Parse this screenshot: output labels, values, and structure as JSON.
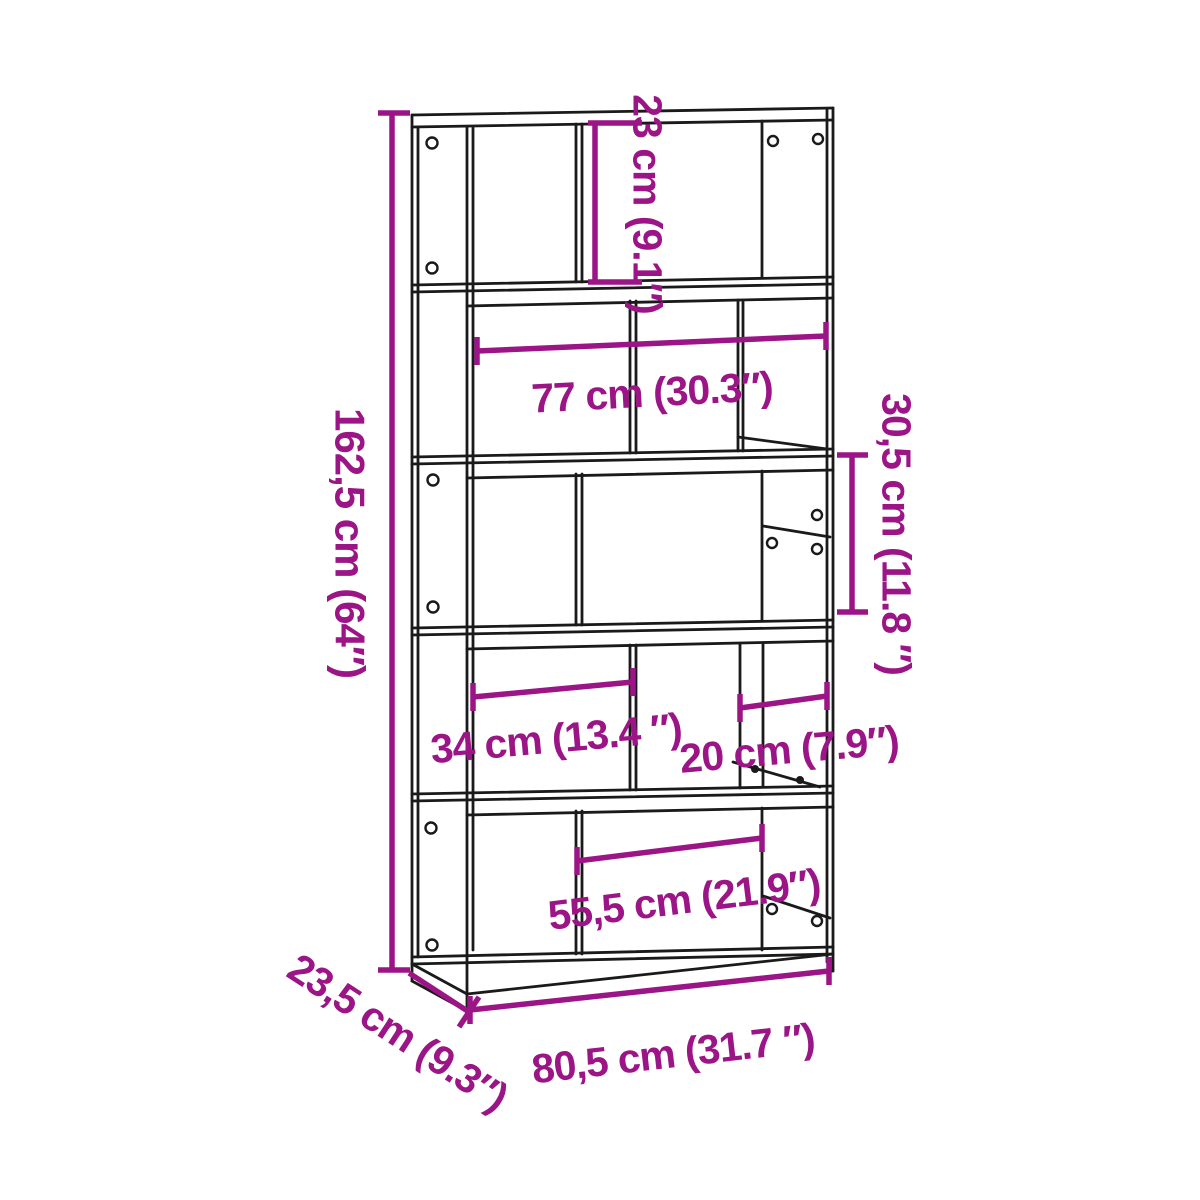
{
  "diagram": {
    "colors": {
      "dimension_accent": "#9b1586",
      "outline": "#1a1a1a",
      "background": "#ffffff"
    },
    "dimensions": {
      "overall_height": "162,5 cm (64″)",
      "top_compartment_height": "23 cm (9.1″)",
      "interior_width": "77 cm (30.3″)",
      "compartment_height": "30,5 cm (11.8 ″)",
      "left_compartment_width": "34 cm (13.4 ″)",
      "right_compartment_width": "20 cm (7.9″)",
      "bottom_compartment_width": "55,5 cm (21.9″)",
      "overall_width": "80,5 cm (31.7 ″)",
      "overall_depth": "23,5 cm (9.3″)"
    }
  }
}
